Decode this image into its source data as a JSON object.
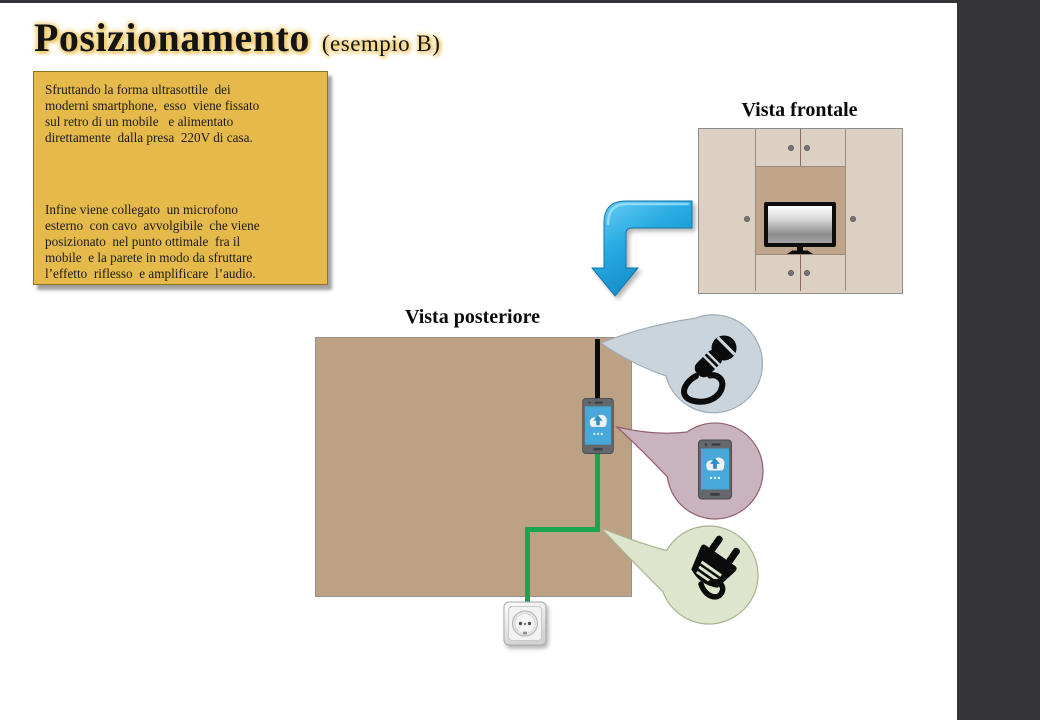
{
  "title": {
    "main": "Posizionamento",
    "suffix": "(esempio B)"
  },
  "info_box": {
    "paragraph1": "Sfruttando la forma ultrasottile  dei\nmoderni smartphone,  esso  viene fissato\nsul retro di un mobile   e alimentato\ndirettamente  dalla presa  220V di casa.",
    "paragraph2": "Infine viene collegato  un microfono\nesterno  con cavo  avvolgibile  che viene\nposizionato  nel punto ottimale  fra il\nmobile  e la parete in modo da sfruttare\nl’effetto  riflesso  e amplificare  l’audio."
  },
  "labels": {
    "front_view": "Vista frontale",
    "rear_view": "Vista posteriore"
  },
  "icons": {
    "curved-arrow-icon": "blue elbow arrow pointing down",
    "tv-icon": "flat-screen television on shelf",
    "microphone-icon": "handheld microphone with coiled cable",
    "smartphone-icon": "smartphone with cloud-upload screen",
    "power-plug-icon": "two-prong power plug with cable",
    "wall-outlet-icon": "220V wall power socket"
  },
  "colors": {
    "c_sidebar": "#343438",
    "c_yellow": "#E5BA4B",
    "c_yellow_border": "#8F731F",
    "c_tan": "#BCA184",
    "c_panel": "#DBD0C1",
    "c_recess": "#C0A58A",
    "c_green": "#18A54E",
    "c_arrow_blue": "#29ABE2",
    "c_screen_blue": "#48A8D9",
    "c_bubble_mic": "#C9D4DC",
    "c_bubble_mic_border": "#9FADB6",
    "c_bubble_phone": "#C8B3BE",
    "c_bubble_phone_border": "#925F70",
    "c_bubble_plug": "#DEE5CD",
    "c_bubble_plug_border": "#A9B28E"
  }
}
